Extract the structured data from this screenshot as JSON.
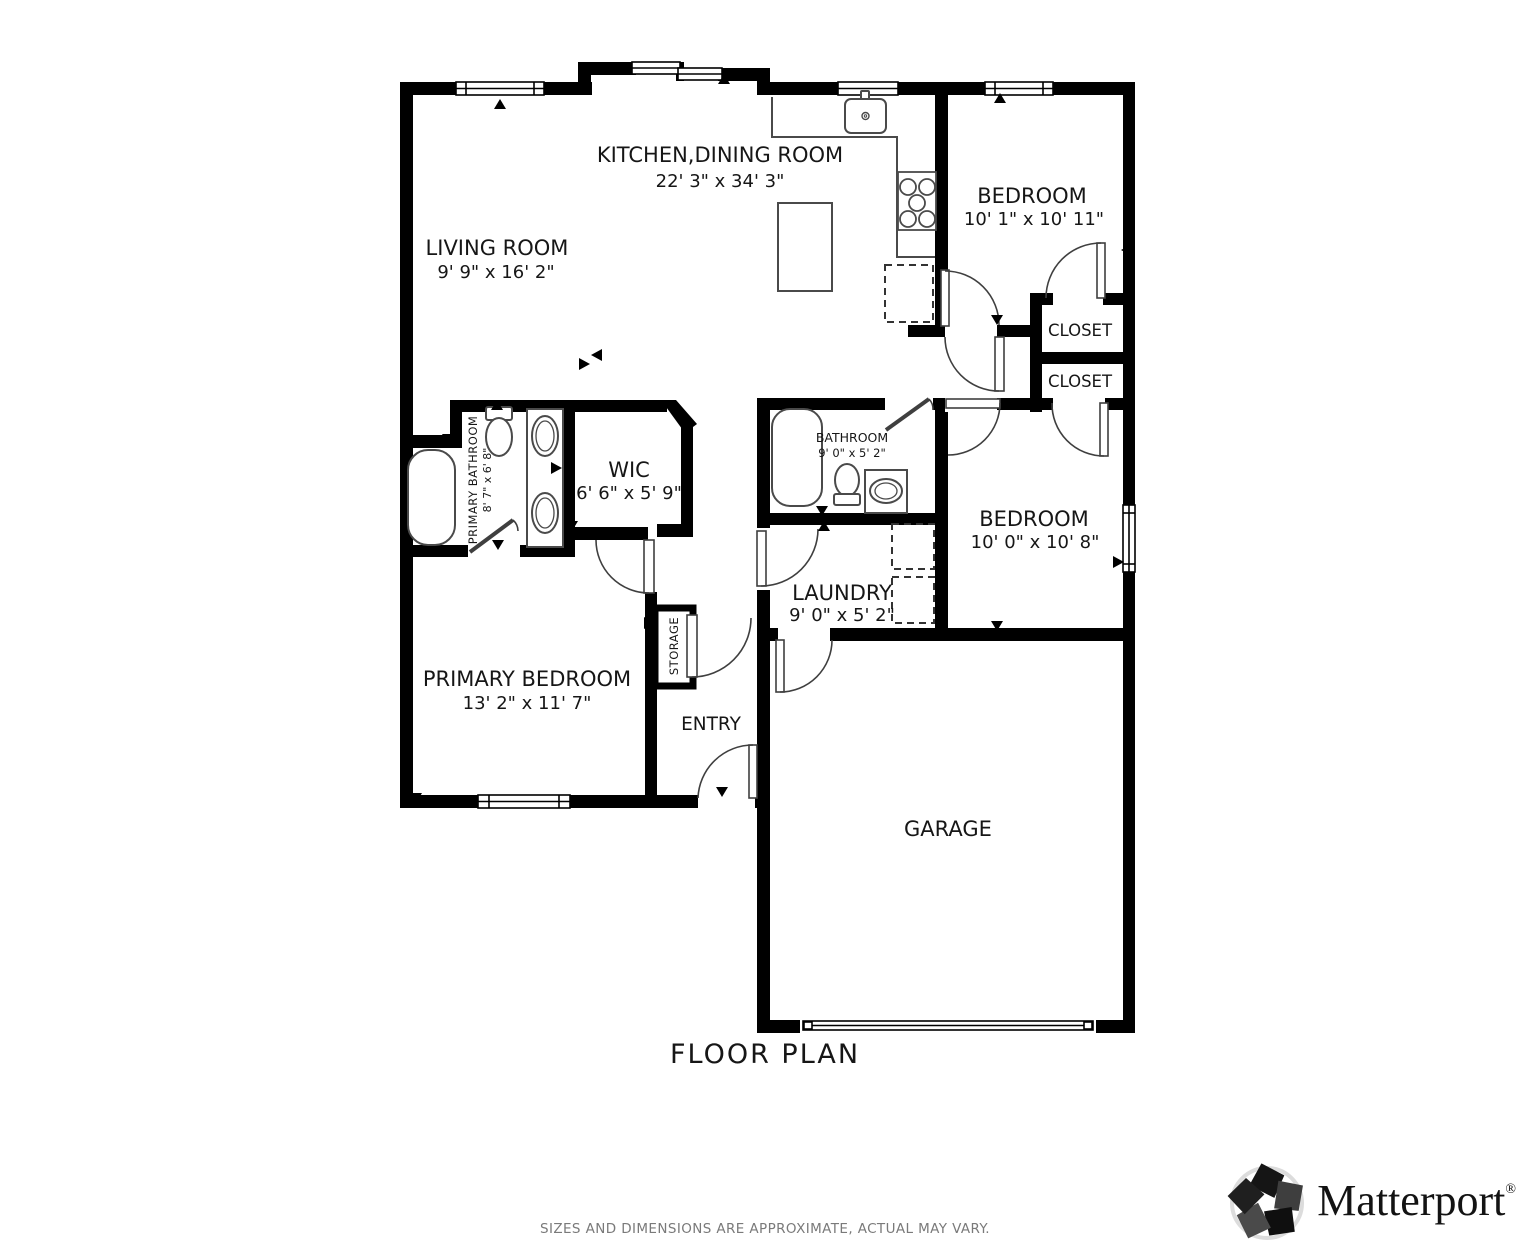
{
  "floor_plan": {
    "title": "FLOOR PLAN",
    "disclaimer": "SIZES AND DIMENSIONS ARE APPROXIMATE, ACTUAL MAY VARY.",
    "rooms": {
      "kitchen_dining": {
        "name": "KITCHEN,DINING ROOM",
        "dims": "22' 3\" x 34' 3\""
      },
      "living_room": {
        "name": "LIVING ROOM",
        "dims": "9' 9\" x 16' 2\""
      },
      "bedroom_top": {
        "name": "BEDROOM",
        "dims": "10' 1\" x 10' 11\""
      },
      "closet_upper": {
        "name": "CLOSET"
      },
      "closet_lower": {
        "name": "CLOSET"
      },
      "primary_bathroom": {
        "name": "PRIMARY BATHROOM",
        "dims": "8' 7\" x 6' 8\""
      },
      "wic": {
        "name": "WIC",
        "dims": "6' 6\" x 5' 9\""
      },
      "bathroom": {
        "name": "BATHROOM",
        "dims": "9' 0\" x 5' 2\""
      },
      "bedroom_middle": {
        "name": "BEDROOM",
        "dims": "10' 0\" x 10' 8\""
      },
      "laundry": {
        "name": "LAUNDRY",
        "dims": "9' 0\" x 5' 2\""
      },
      "storage": {
        "name": "STORAGE"
      },
      "entry": {
        "name": "ENTRY"
      },
      "primary_bedroom": {
        "name": "PRIMARY BEDROOM",
        "dims": "13' 2\" x 11' 7\""
      },
      "garage": {
        "name": "GARAGE"
      }
    },
    "colors": {
      "wall": "#000000",
      "fixture_line": "#4a4a4a",
      "disclaimer_text": "#7a7a7a"
    }
  },
  "brand": {
    "name": "Matterport",
    "registered": "®"
  }
}
